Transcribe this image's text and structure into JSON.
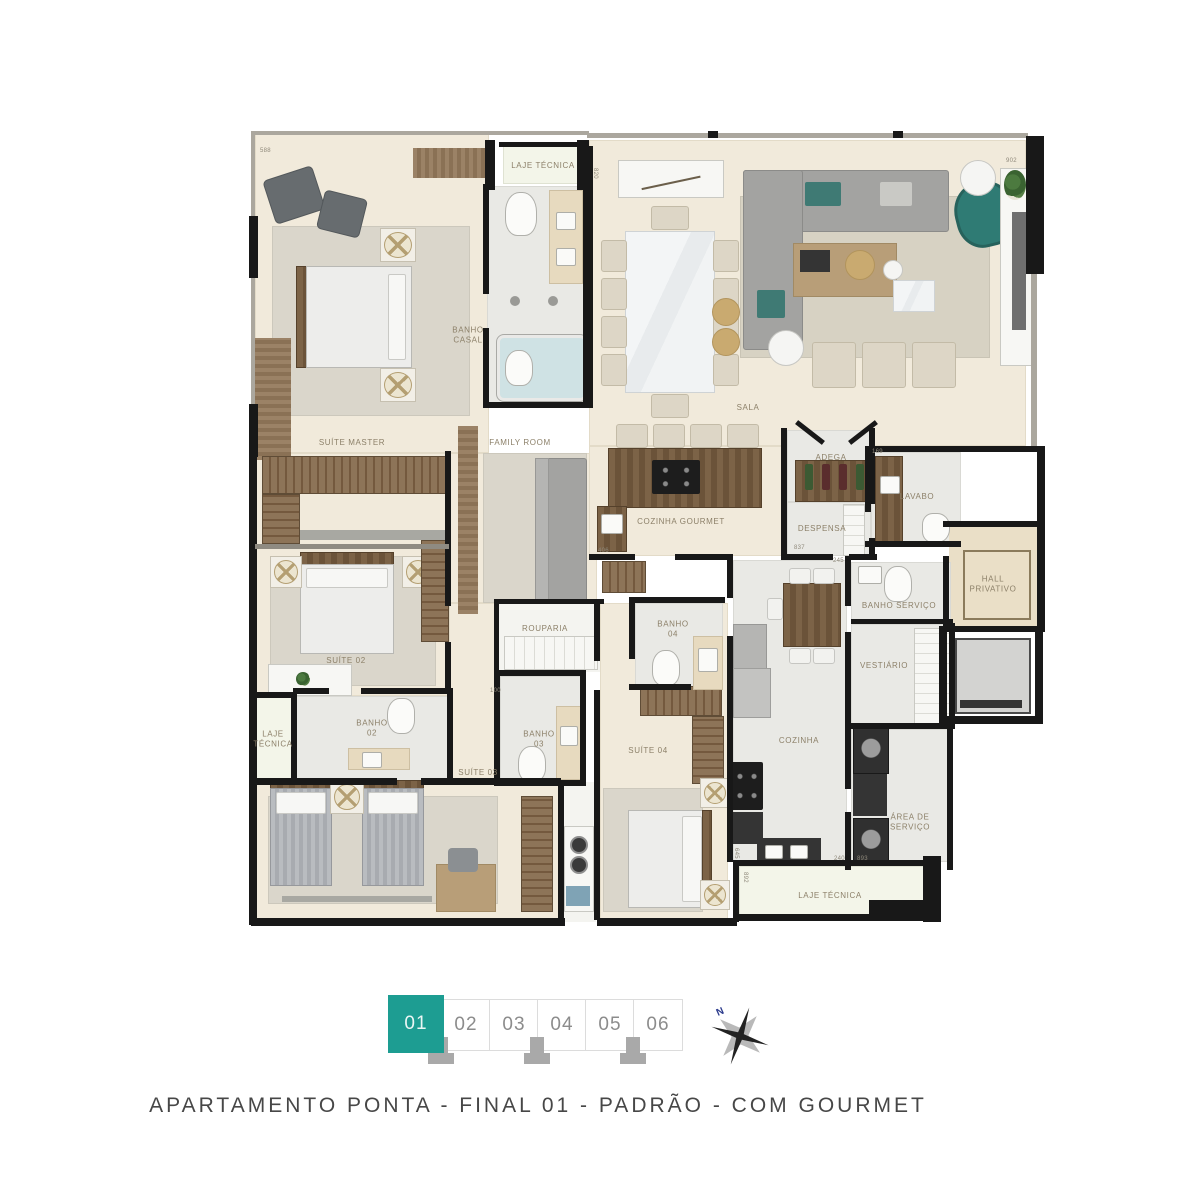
{
  "page": {
    "caption": "APARTAMENTO PONTA - FINAL 01 - PADRÃO - COM GOURMET"
  },
  "compass": {
    "north_label": "N"
  },
  "selector": {
    "selected": "01",
    "units": [
      {
        "label": "01",
        "selected": true
      },
      {
        "label": "02",
        "selected": false
      },
      {
        "label": "03",
        "selected": false
      },
      {
        "label": "04",
        "selected": false
      },
      {
        "label": "05",
        "selected": false
      },
      {
        "label": "06",
        "selected": false
      }
    ]
  },
  "plan": {
    "room_labels": [
      {
        "t": "LAJE TÉCNICA",
        "x": 543,
        "y": 166
      },
      {
        "t": "BANHO\nCASAL",
        "x": 468,
        "y": 336
      },
      {
        "t": "SALA",
        "x": 748,
        "y": 408
      },
      {
        "t": "SUÍTE MASTER",
        "x": 352,
        "y": 443
      },
      {
        "t": "FAMILY ROOM",
        "x": 520,
        "y": 443
      },
      {
        "t": "COZINHA GOURMET",
        "x": 681,
        "y": 522
      },
      {
        "t": "ADEGA",
        "x": 831,
        "y": 458
      },
      {
        "t": "DESPENSA",
        "x": 822,
        "y": 529
      },
      {
        "t": "LAVABO",
        "x": 917,
        "y": 497
      },
      {
        "t": "HALL\nPRIVATIVO",
        "x": 993,
        "y": 585
      },
      {
        "t": "BANHO SERVIÇO",
        "x": 899,
        "y": 606
      },
      {
        "t": "VESTIÁRIO",
        "x": 884,
        "y": 666
      },
      {
        "t": "ROUPARIA",
        "x": 545,
        "y": 629
      },
      {
        "t": "SUÍTE 02",
        "x": 346,
        "y": 661
      },
      {
        "t": "BANHO\n02",
        "x": 372,
        "y": 729
      },
      {
        "t": "LAJE\nTÉCNICA",
        "x": 273,
        "y": 740
      },
      {
        "t": "BANHO\n03",
        "x": 539,
        "y": 740
      },
      {
        "t": "SUÍTE 03",
        "x": 478,
        "y": 773
      },
      {
        "t": "BANHO\n04",
        "x": 673,
        "y": 630
      },
      {
        "t": "SUÍTE 04",
        "x": 648,
        "y": 751
      },
      {
        "t": "COZINHA",
        "x": 799,
        "y": 741
      },
      {
        "t": "ÁREA DE\nSERVIÇO",
        "x": 910,
        "y": 823
      },
      {
        "t": "LAJE TÉCNICA",
        "x": 830,
        "y": 896
      }
    ],
    "dimensions": [
      {
        "t": "588",
        "x": 260,
        "y": 148
      },
      {
        "t": "820",
        "x": 592,
        "y": 168,
        "v": true
      },
      {
        "t": "902",
        "x": 1006,
        "y": 158
      },
      {
        "t": "406",
        "x": 598,
        "y": 548
      },
      {
        "t": "169",
        "x": 872,
        "y": 449
      },
      {
        "t": "837",
        "x": 794,
        "y": 545
      },
      {
        "t": "245",
        "x": 833,
        "y": 558
      },
      {
        "t": "100",
        "x": 490,
        "y": 688
      },
      {
        "t": "645",
        "x": 733,
        "y": 848,
        "v": true
      },
      {
        "t": "240",
        "x": 834,
        "y": 856
      },
      {
        "t": "893",
        "x": 857,
        "y": 856
      },
      {
        "t": "892",
        "x": 742,
        "y": 872,
        "v": true
      }
    ]
  }
}
